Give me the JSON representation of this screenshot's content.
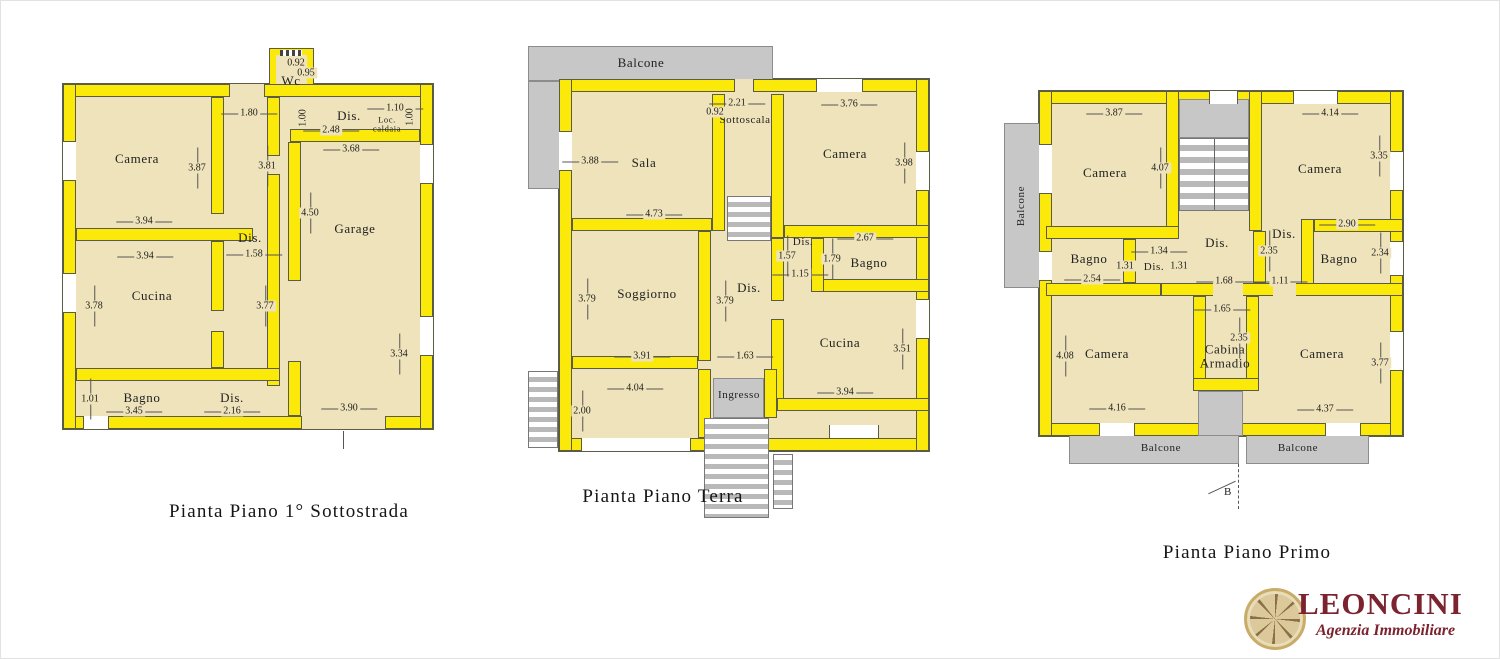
{
  "colors": {
    "wall": "#fbe90a",
    "floor": "#eee3ba",
    "balcony": "#c7c7c7",
    "outline": "#5c5c46",
    "logo_red": "#7b232e",
    "logo_gold": "#c9ac67"
  },
  "titles": {
    "p1": "Pianta Piano 1° Sottostrada",
    "p2": "Pianta Piano Terra",
    "p3": "Pianta Piano Primo"
  },
  "plans": {
    "p1": {
      "rooms": {
        "camera": "Camera",
        "cucina": "Cucina",
        "bagno": "Bagno",
        "garage": "Garage",
        "wc": "Wc",
        "dis_top": "Dis.",
        "dis_mid": "Dis.",
        "dis_bot": "Dis.",
        "loc_caldaia": "Loc. caldaia"
      },
      "dims": {
        "d092": "0.92",
        "d095": "0.95",
        "d180": "1.80",
        "d110": "1.10",
        "d100a": "1.00",
        "d100b": "1.00",
        "d248": "2.48",
        "d368": "3.68",
        "d387": "3.87",
        "d381": "3.81",
        "d394a": "3.94",
        "d450": "4.50",
        "d394b": "3.94",
        "d158": "1.58",
        "d378": "3.78",
        "d377": "3.77",
        "d334": "3.34",
        "d101": "1.01",
        "d345": "3.45",
        "d216": "2.16",
        "d390": "3.90"
      }
    },
    "p2": {
      "rooms": {
        "balcone": "Balcone",
        "sala": "Sala",
        "sottoscala": "Sottoscala",
        "camera": "Camera",
        "dis_a": "Dis.",
        "bagno": "Bagno",
        "dis_b": "Dis.",
        "soggiorno": "Soggiorno",
        "cucina": "Cucina",
        "ingresso": "Ingresso"
      },
      "dims": {
        "d221": "2.21",
        "d092": "0.92",
        "d376": "3.76",
        "d388": "3.88",
        "d398": "3.98",
        "d473": "4.73",
        "d267": "2.67",
        "d157": "1.57",
        "d179": "1.79",
        "d115": "1.15",
        "d379a": "3.79",
        "d379b": "3.79",
        "d391": "3.91",
        "d163": "1.63",
        "d351": "3.51",
        "d404": "4.04",
        "d200": "2.00",
        "d394": "3.94"
      }
    },
    "p3": {
      "rooms": {
        "balcone_left": "Balcone",
        "camera_tl": "Camera",
        "camera_tr": "Camera",
        "bagno_l": "Bagno",
        "dis_s": "Dis.",
        "dis_c": "Dis.",
        "dis_r": "Dis.",
        "bagno_r": "Bagno",
        "camera_bl": "Camera",
        "cabina": "Cabina Armadio",
        "camera_br": "Camera",
        "balcone_b1": "Balcone",
        "balcone_b2": "Balcone",
        "section_b": "B"
      },
      "dims": {
        "d387": "3.87",
        "d414": "4.14",
        "d407": "4.07",
        "d335": "3.35",
        "d290": "2.90",
        "d235a": "2.35",
        "d134": "1.34",
        "d131a": "1.31",
        "d131b": "1.31",
        "d254": "2.54",
        "d234": "2.34",
        "d168": "1.68",
        "d111": "1.11",
        "d165": "1.65",
        "d235b": "2.35",
        "d408": "4.08",
        "d377": "3.77",
        "d416": "4.16",
        "d437": "4.37"
      }
    }
  },
  "logo": {
    "name": "LEONCINI",
    "tagline": "Agenzia Immobiliare"
  }
}
